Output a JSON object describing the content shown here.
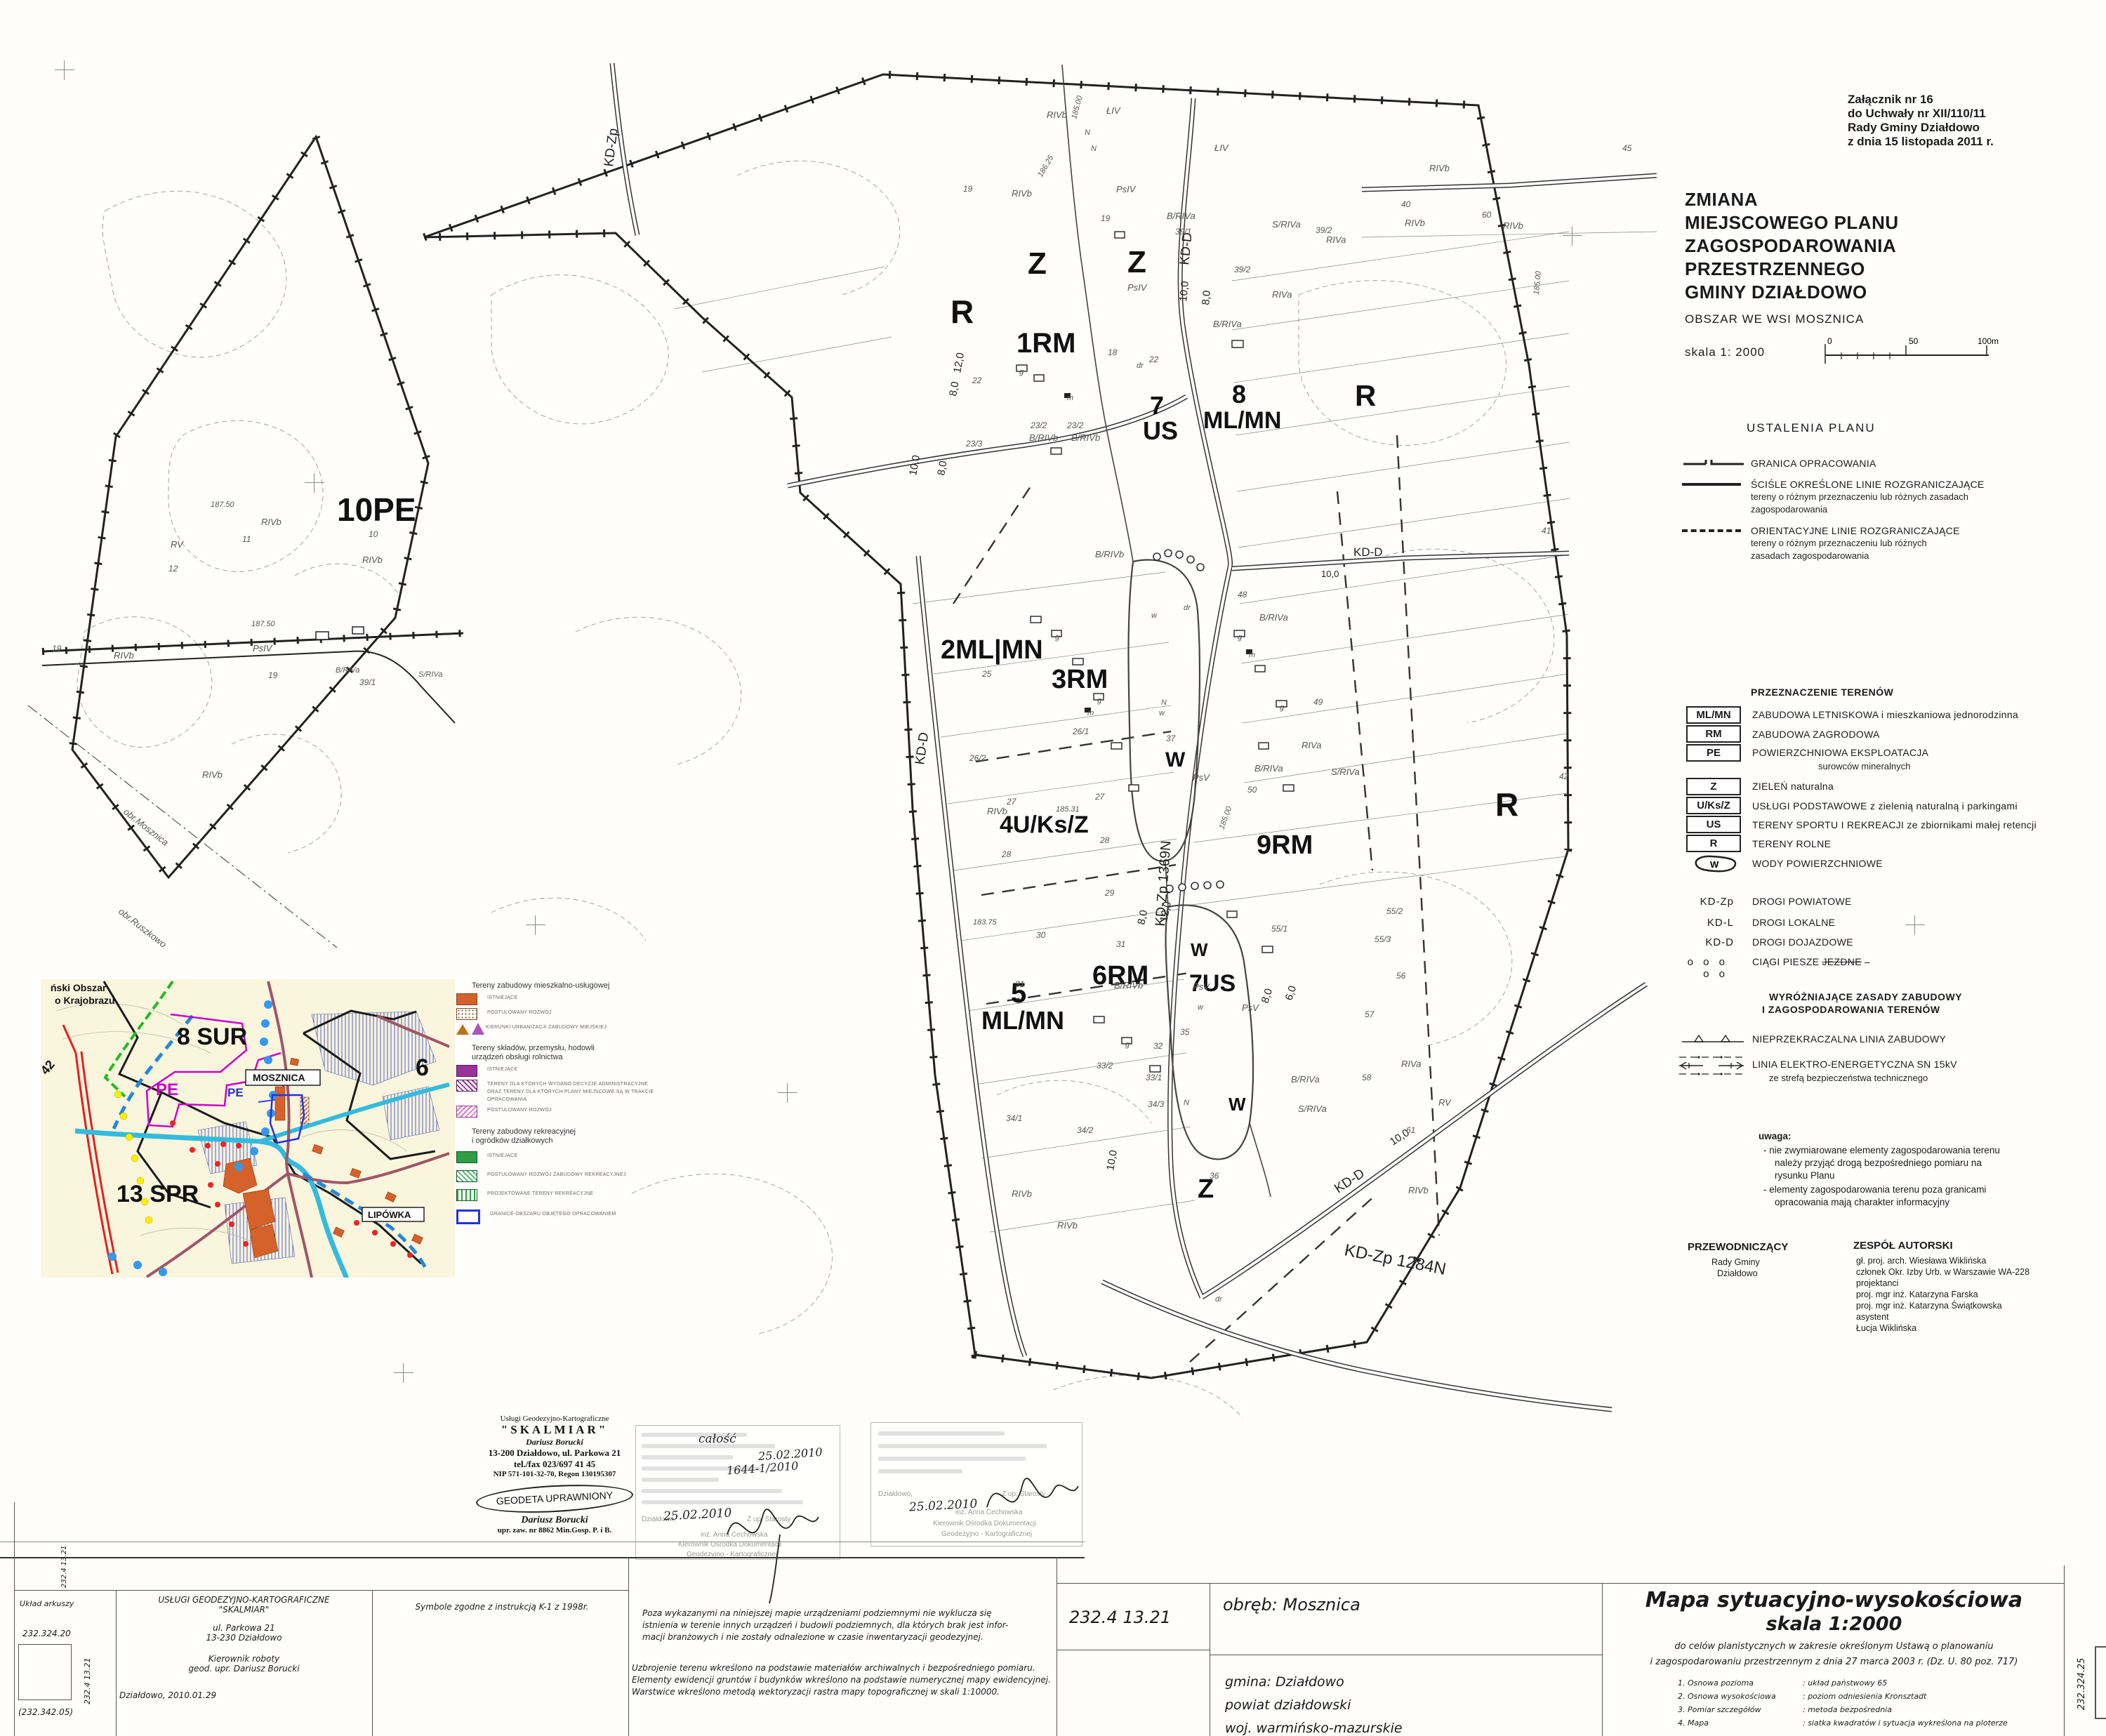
{
  "doc": {
    "attachment": [
      "Załącznik  nr 16",
      "do Uchwały nr   XII/110/11",
      "Rady Gminy  Działdowo",
      "z dnia   15 listopada 2011 r."
    ],
    "title": [
      "ZMIANA",
      "MIEJSCOWEGO PLANU",
      "ZAGOSPODAROWANIA",
      "PRZESTRZENNEGO",
      "GMINY DZIAŁDOWO"
    ],
    "area": "OBSZAR  WE  WSI MOSZNICA",
    "scale": "skala   1: 2000",
    "scalebar": {
      "t0": "0",
      "t50": "50",
      "t100": "100m"
    }
  },
  "legend1": {
    "header": "USTALENIA  PLANU",
    "items": [
      {
        "label": "GRANICA  OPRACOWANIA",
        "sub1": "",
        "sub2": ""
      },
      {
        "label": "ŚCIŚLE  OKREŚLONE  LINIE  ROZGRANICZAJĄCE",
        "sub1": "tereny o różnym przeznaczeniu lub różnych zasadach",
        "sub2": "zagospodarowania"
      },
      {
        "label": "ORIENTACYJNE LINIE  ROZGRANICZAJĄCE",
        "sub1": "tereny  o  różnym  przeznaczeniu  lub  różnych",
        "sub2": "zasadach zagospodarowania"
      }
    ]
  },
  "legend2": {
    "header": "PRZEZNACZENIE TERENÓW",
    "items": [
      {
        "code": "ML/MN",
        "label": "ZABUDOWA LETNISKOWA  i mieszkaniowa jednorodzinna",
        "sub": ""
      },
      {
        "code": "RM",
        "label": "ZABUDOWA ZAGRODOWA",
        "sub": ""
      },
      {
        "code": "PE",
        "label": "POWIERZCHNIOWA EKSPLOATACJA",
        "sub": "surowców mineralnych"
      },
      {
        "code": "Z",
        "label": "ZIELEŃ naturalna",
        "sub": ""
      },
      {
        "code": "U/Ks/Z",
        "label": "USŁUGI  PODSTAWOWE  z  zielenią naturalną i parkingami",
        "sub": ""
      },
      {
        "code": "US",
        "label": "TERENY SPORTU I REKREACJI ze zbiornikami małej retencji",
        "sub": ""
      },
      {
        "code": "R",
        "label": "TERENY ROLNE",
        "sub": ""
      },
      {
        "code": "W",
        "label": "WODY POWIERZCHNIOWE",
        "sub": ""
      }
    ],
    "roads": [
      {
        "code": "KD-Zp",
        "label": "DROGI POWIATOWE"
      },
      {
        "code": "KD-L",
        "label": "DROGI LOKALNE"
      },
      {
        "code": "KD-D",
        "label": "DROGI DOJAZDOWE"
      },
      {
        "code": "o o o o o",
        "label": "CIĄGI  PIESZE ",
        "label2": "JEZDNE"
      }
    ]
  },
  "legend3": {
    "header1": "WYRÓŻNIAJĄCE ZASADY ZABUDOWY",
    "header2": "I   ZAGOSPODAROWANIA    TERENÓW",
    "item1": "NIEPRZEKRACZALNA LINIA ZABUDOWY",
    "item2": "LINIA ELEKTRO-ENERGETYCZNA SN 15kV",
    "item2sub": "ze strefą bezpieczeństwa technicznego"
  },
  "uwaga": {
    "header": "uwaga:",
    "b1": "-  nie zwymiarowane elementy zagospodarowania  terenu",
    "b2": "należy  przyjąć  drogą  bezpośredniego  pomiaru   na",
    "b3": "rysunku Planu",
    "b4": "-  elementy  zagospodarowania  terenu  poza  granicami",
    "b5": "opracowania mają charakter informacyjny"
  },
  "sign": {
    "p1": "PRZEWODNICZĄCY",
    "p2": "Rady  Gminy",
    "p3": "Działdowo",
    "zh": "ZESPÓŁ AUTORSKI",
    "z1": "gł. proj. arch.  Wiesława  Wiklińska",
    "z2": "członek Okr. Izby Urb. w Warszawie WA-228",
    "z3": "projektanci",
    "z4": "proj. mgr inż. Katarzyna Farska",
    "z5": "proj. mgr inż. Katarzyna Świątkowska",
    "z6": "asystent",
    "z7": "Łucja Wiklińska"
  },
  "map": {
    "zones": {
      "z": "Z",
      "r": "R",
      "rm1": "1RM",
      "n7": "7",
      "us": "US",
      "n8": "8",
      "mlmn": "ML/MN",
      "ml2": "2ML|MN",
      "rm3": "3RM",
      "rm9": "9RM",
      "uksz": "4U/Ks/Z",
      "n5": "5",
      "rm6": "6RM",
      "us7": "7US",
      "w": "W"
    },
    "roads": {
      "kdzp": "KD-Zp",
      "kdd": "KD-D",
      "z1369": "KD-Zp 1369N",
      "z1284": "KD-Zp 1284N"
    },
    "dims": {
      "d10": "10,0",
      "d8": "8,0",
      "d12": "12,0",
      "d6": "6,0"
    },
    "soil": {
      "rivb": "RIVb",
      "riva": "RIVa",
      "psiv": "PsIV",
      "psv": "PsV",
      "liv": "ŁIV",
      "rv": "RV",
      "brivb": "B/RIVb",
      "briva": "B/RIVa",
      "sriva": "S/RIVa"
    },
    "contours": {
      "c18500": "185.00",
      "c18625": "186.25",
      "c18531": "185.31",
      "c18750": "187.50",
      "c18375": "183.75"
    },
    "misc": {
      "dr": "dr",
      "g": "g",
      "m": "m",
      "n": "N",
      "w": "w",
      "coord": "5850000    5850000"
    },
    "parcels": [
      "39/1",
      "39/2",
      "23/2",
      "23/3",
      "25",
      "26/1",
      "26/2",
      "27",
      "28",
      "29",
      "30",
      "31",
      "32",
      "33/1",
      "33/2",
      "34/1",
      "34/2",
      "34/3",
      "35",
      "36",
      "37",
      "48",
      "49",
      "50",
      "55/1",
      "55/2",
      "55/3",
      "56",
      "57",
      "58",
      "61",
      "40",
      "60",
      "41",
      "42",
      "45",
      "11",
      "12",
      "19",
      "22",
      "18",
      "10"
    ]
  },
  "leftmap": {
    "pe10": "10PE",
    "obr1": "obr.Mosznica",
    "obr2": "obr.Ruszkowo"
  },
  "inset": {
    "corner1": "ński Obszar",
    "corner2": "o Krajobrazu",
    "sur8": "8 SUR",
    "pe1": "PE",
    "pe2": "PE",
    "mosznica": "MOSZNICA",
    "n6": "6",
    "spr13": "13 SPR",
    "lipowka": "LIPÓWKA",
    "n42": "42"
  },
  "inset_legend": {
    "h1": "Tereny zabudowy mieszkalno-usługowej",
    "g1a": "ISTNIEJĄCE",
    "g1b": "POSTULOWANY ROZWÓJ",
    "g1c": "KIERUNKI URBANIZACJI ZABUDOWY MIEJSKIEJ",
    "h2a": "Tereny składów, przemysłu, hodowli",
    "h2b": "urządzeń obsługi rolnictwa",
    "g2a": "ISTNIEJĄCE",
    "g2b1": "TERENY  DLA  KTÓRYCH  WYDANO  DECYZJE  ADMINISTRACYJNE",
    "g2b2": "ORAZ TERENY DLA KTÓRYCH PLANY MIEJSCOWE SĄ W TRAKCIE",
    "g2b3": "OPRACOWANIA",
    "g2c": "POSTULOWANY ROZWÓJ",
    "h3a": "Tereny zabudowy rekreacyjnej",
    "h3b": "i ogródków działkowych",
    "g3a": "ISTNIEJĄCE",
    "g3b": "POSTULOWANY ROZWÓJ ZABUDOWY REKREACYJNEJ",
    "g3c": "PROJEKTOWANE TERENY REKREACYJNE",
    "g3d": "GRANICE OBSZARU OBJĘTEGO OPRACOWANIEM"
  },
  "stamps": {
    "skalmiar": {
      "l0": "Usługi Geodezyjno-Kartograficzne",
      "l1": "\"SKALMIAR\"",
      "l2": "Dariusz Borucki",
      "l3": "13-200 Działdowo, ul. Parkowa 21",
      "l4": "tel./fax 023/697 41 45",
      "l5": "NIP 571-101-32-70, Regon 130195307",
      "oval": "GEODETA UPRAWNIONY",
      "sig": "Dariusz Borucki",
      "upr": "upr. zaw. nr 8862  Min.Gosp. P. i B."
    },
    "left": {
      "hand1": "całość",
      "date_top": "25.02.2010",
      "number": "1644-1/2010",
      "date_bottom": "25.02.2010",
      "city": "Działdowo,",
      "zup": "Z up. Starosty",
      "name": "inż. Anna Cechowska",
      "role1": "Kierownik Ośrodka Dokumentacji",
      "role2": "Geodezyjno - Kartograficznej"
    },
    "right": {
      "date": "25.02.2010",
      "city": "Działdowo,",
      "zup": "Z up. Starosty",
      "name": "inż. Anna Cechowska",
      "role1": "Kierownik Ośrodka Dokumentacji",
      "role2": "Geodezyjno - Kartograficznej"
    }
  },
  "footer": {
    "uklad": "Układ arkuszy",
    "sheet_top": "232.324.20",
    "sheet_side": "232.4 13.21",
    "sheet_bottom": "(232.342.05)",
    "c2l1": "USŁUGI GEODEZYJNO-KARTOGRAFICZNE",
    "c2l2": "\"SKALMIAR\"",
    "c2l3": "ul. Parkowa 21",
    "c2l4": "13-230 Działdowo",
    "c2l5": "Kierownik roboty",
    "c2l6": "geod. upr. Dariusz Borucki",
    "c2l7": "Działdowo, 2010.01.29",
    "c3": "Symbole zgodne z instrukcją K-1 z  1998r.",
    "n1a": "Poza wykazanymi na niniejszej mapie urządzeniami podziemnymi nie wyklucza się",
    "n1b": "istnienia w terenie innych urządzeń i budowli podziemnych, dla których brak jest infor-",
    "n1c": "macji branżowych i nie zostały odnalezione w czasie inwentaryzacji geodezyjnej.",
    "n2a": "Uzbrojenie terenu wkreślono na podstawie materiałów archiwalnych i bezpośredniego pomiaru.",
    "n2b": "Elementy ewidencji gruntów i budynków wkreślono na podstawie numerycznej mapy ewidencyjnej.",
    "n2c": "Warstwice wkreślono metodą wektoryzacji rastra mapy topograficznej w skali  1:10000.",
    "sheet_big": "232.4 13.21",
    "obreb": "obręb: Mosznica",
    "gmina": "gmina: Działdowo",
    "powiat": "powiat działdowski",
    "woj": "woj. warmińsko-mazurskie",
    "mt1": "Mapa sytuacyjno-wysokościowa",
    "mt2": "skala  1:2000",
    "p1": "do celów planistycznych w zakresie określonym Ustawą o planowaniu",
    "p2": "i zagospodarowaniu przestrzennym z dnia 27 marca 2003 r. (Dz. U. 80 poz. 717)",
    "items": [
      {
        "n": "1. Osnowa pozioma",
        "v": ":  układ państwowy 65"
      },
      {
        "n": "2. Osnowa wysokościowa",
        "v": ":  poziom odniesienia Kronsztadt"
      },
      {
        "n": "3. Pomiar szczegółów",
        "v": ":  metoda bezpośrednia"
      },
      {
        "n": "4. Mapa",
        "v": ":  siatka kwadratów i sytuacja wykreślona na ploterze"
      }
    ],
    "right_vert": "232.324.25"
  },
  "colors": {
    "orange": "#d4622a",
    "purple": "#993399",
    "magenta": "#cc00cc",
    "green": "#2e9e44",
    "blue": "#2233dd",
    "cyan": "#33bbdd",
    "red": "#dd2222",
    "yellow": "#ffee00",
    "maroon": "#a05566",
    "cream": "#faf5dd"
  }
}
